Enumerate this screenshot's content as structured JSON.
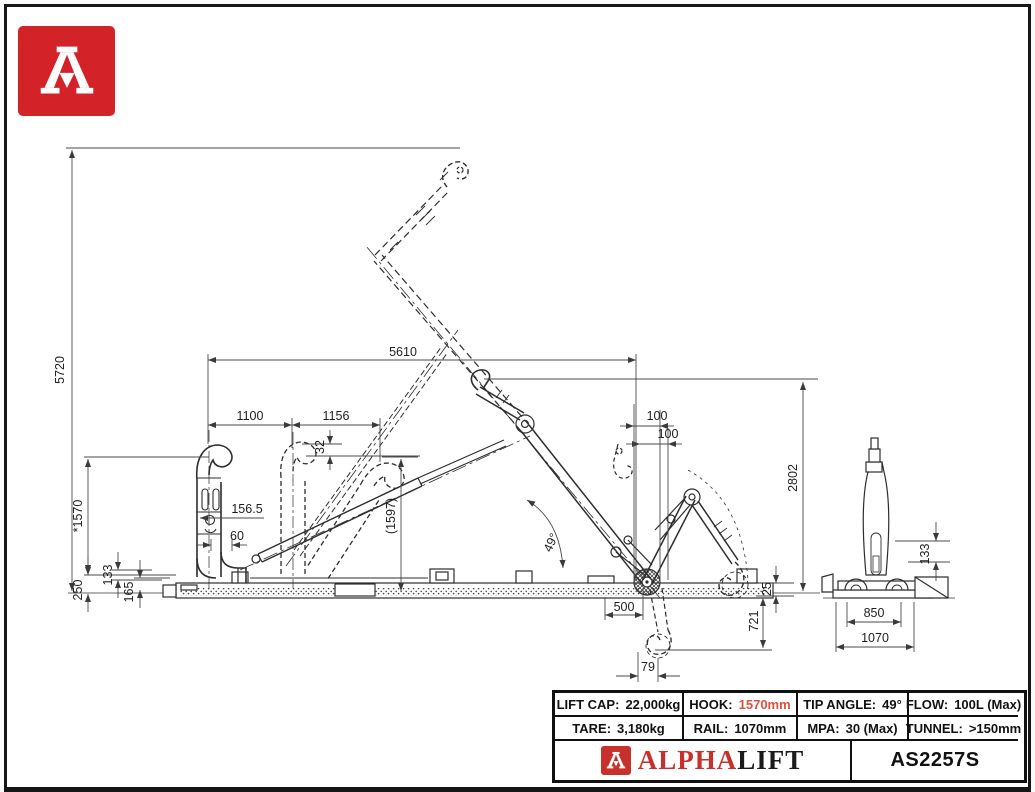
{
  "page": {
    "paper_color": "#ffffff",
    "border_color": "#161616",
    "line_color": "#2d2d2d",
    "accent_red": "#c8302c",
    "value_red": "#e0503c"
  },
  "logo": {
    "glyph": "A"
  },
  "drawing": {
    "dims": {
      "overall_height": "5720",
      "horizontal_reach": "5610",
      "seg_1100": "1100",
      "seg_1156": "1156",
      "offset_32": "32",
      "offset_100a": "100",
      "offset_100b": "100",
      "mid_height": "2802",
      "hook_height": "*1570",
      "offset_156_5": "156.5",
      "offset_60": "60",
      "ref_1597": "(1597)",
      "offset_133": "133",
      "offset_250": "250",
      "offset_165": "165",
      "offset_500": "500",
      "tip_angle": "49°",
      "offset_25": "25",
      "below_ground_721": "721",
      "offset_79": "79",
      "front_133": "133",
      "front_850": "850",
      "front_1070": "1070"
    }
  },
  "spec_table": {
    "rows": [
      [
        {
          "label": "LIFT CAP:",
          "value": "22,000kg"
        },
        {
          "label": "HOOK:",
          "value": "1570mm"
        },
        {
          "label": "TIP ANGLE:",
          "value": "49°"
        },
        {
          "label": "FLOW:",
          "value": "100L (Max)"
        }
      ],
      [
        {
          "label": "TARE:",
          "value": "3,180kg"
        },
        {
          "label": "RAIL:",
          "value": "1070mm"
        },
        {
          "label": "MPA:",
          "value": "30 (Max)"
        },
        {
          "label": "TUNNEL:",
          "value": ">150mm"
        }
      ]
    ],
    "brand": {
      "alpha": "ALPHA",
      "lift": "LIFT"
    },
    "model": "AS2257S"
  }
}
